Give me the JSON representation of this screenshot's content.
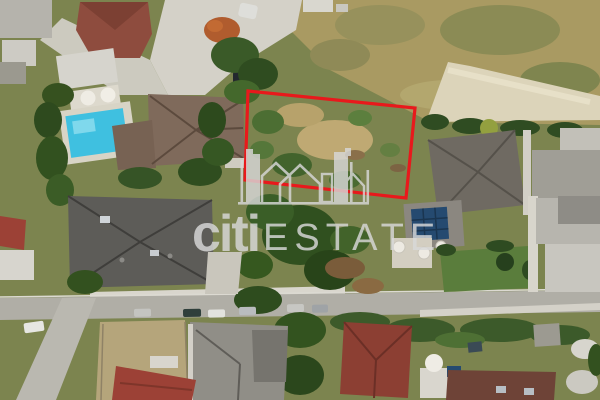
{
  "image": {
    "kind": "aerial-drone-photo",
    "width": 600,
    "height": 400
  },
  "watermark": {
    "brand_primary": "citi",
    "brand_secondary": "ESTATE",
    "color": "#d9d9d9",
    "logo": "building-skyline"
  },
  "plot_outline": {
    "color": "#e8191c",
    "stroke_width": "3.2",
    "corners": "248,91 415,108 406,198 245,180"
  },
  "scene": {
    "pool_color": "#3fc0e0",
    "dry_field_color": "#a99a62",
    "road_color": "#b0aea6",
    "parking_color": "#d4d1c8",
    "tree_color": "#33521f",
    "villa_roof_color": "#7f6a5b",
    "dark_roof_color": "#5d5c58",
    "red_roof_color": "#9c4136",
    "brick_roof_color": "#8e4c3e",
    "solar_panel_color": "#254a70"
  }
}
